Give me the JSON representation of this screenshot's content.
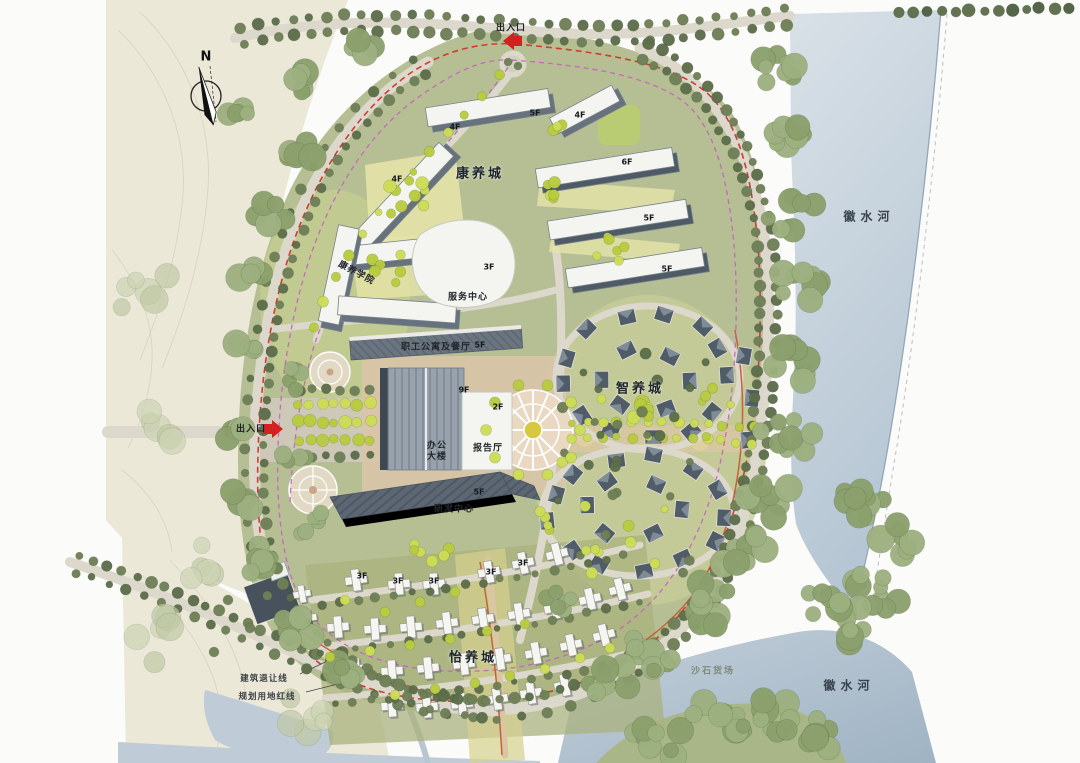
{
  "colors": {
    "paper": "#fbfbf9",
    "terrain": "#ebe8d8",
    "contour": "#d6d2bd",
    "water_top": "#d8e0e6",
    "water_mid": "#bfccd7",
    "water_deep": "#a4b8c7",
    "shore": "#93a7b6",
    "site_base": "#b6bf94",
    "site_light": "#c9d09b",
    "court_yellow": "#e6e4a9",
    "lawn_bright": "#c7d290",
    "ground_olive": "#a9b27e",
    "band_yellow": "#d5d28e",
    "road": "#dcd8cc",
    "road_tan": "#d9c6a2",
    "plaza_tan": "#d9c4a8",
    "esplanade": "#cfc9bb",
    "roof_dark": "#4e5a66",
    "roof_mid": "#67727d",
    "roof_light": "#98a2ac",
    "bldg_white": "#f4f4f0",
    "villa_roof": "#505c68",
    "villa_light": "#8793a0",
    "tree_olive": "#6f7f57",
    "tree_dark": "#5d6e4b",
    "tree_sage": "#9db07f",
    "tree_sage2": "#8ba06c",
    "tree_bright": "#b9cc3f",
    "tree_yellow": "#cddd55",
    "redline": "#d23c2e",
    "magenta": "#c75fc1",
    "trail": "#c8552f",
    "arrow": "#d42020",
    "ink": "#23282d"
  },
  "compass": {
    "label": "N"
  },
  "entrances": {
    "top": {
      "label": "出入口"
    },
    "west": {
      "label": "出入口"
    }
  },
  "districts": {
    "kangyang": {
      "label": "康养城"
    },
    "zhiyang": {
      "label": "智养城"
    },
    "yiyang": {
      "label": "怡养城"
    }
  },
  "buildings": {
    "college": {
      "label": "康养学院"
    },
    "service_center": {
      "label": "服务中心"
    },
    "staff_apartment": {
      "label": "职工公寓及餐厅"
    },
    "office_tower": {
      "label": "办公大楼"
    },
    "lecture_hall": {
      "label": "报告厅"
    },
    "rd_center": {
      "label": "研发中心"
    }
  },
  "river": {
    "label": "徽水河"
  },
  "site_notes": {
    "gravel_yard": "沙石货场",
    "building_setback_line": "建筑退让线",
    "planning_red_line": "规划用地红线"
  },
  "floor_tags": [
    {
      "text": "5F",
      "x": 535,
      "y": 113
    },
    {
      "text": "4F",
      "x": 580,
      "y": 115
    },
    {
      "text": "4F",
      "x": 455,
      "y": 127
    },
    {
      "text": "4F",
      "x": 397,
      "y": 179
    },
    {
      "text": "6F",
      "x": 627,
      "y": 162
    },
    {
      "text": "5F",
      "x": 649,
      "y": 218
    },
    {
      "text": "5F",
      "x": 667,
      "y": 269
    },
    {
      "text": "3F",
      "x": 489,
      "y": 267
    },
    {
      "text": "5F",
      "x": 480,
      "y": 345
    },
    {
      "text": "9F",
      "x": 464,
      "y": 390
    },
    {
      "text": "2F",
      "x": 498,
      "y": 407
    },
    {
      "text": "5F",
      "x": 479,
      "y": 492
    },
    {
      "text": "3F",
      "x": 362,
      "y": 576
    },
    {
      "text": "3F",
      "x": 398,
      "y": 581
    },
    {
      "text": "3F",
      "x": 434,
      "y": 581
    },
    {
      "text": "3F",
      "x": 491,
      "y": 572
    },
    {
      "text": "3F",
      "x": 523,
      "y": 563
    }
  ]
}
